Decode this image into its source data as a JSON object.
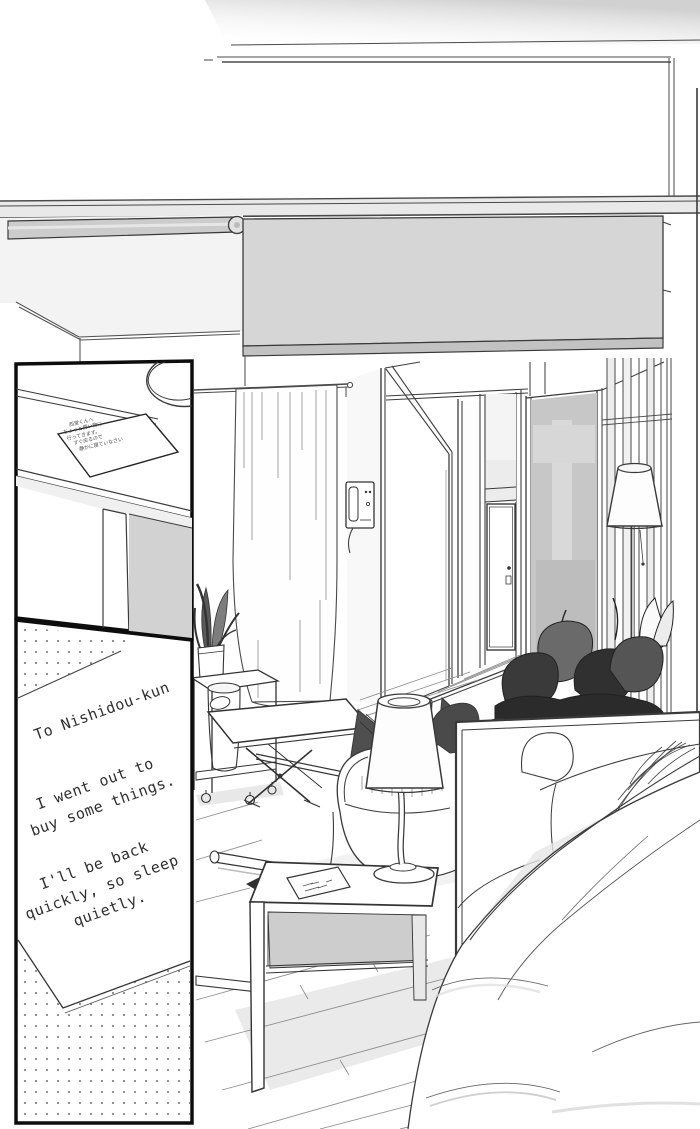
{
  "caption": {
    "block1": {
      "line1": "To Nishidou-kun"
    },
    "block2": {
      "line1": "I went out to",
      "line2": "buy some things."
    },
    "block3": {
      "line1": "I'll be back",
      "line2": "quickly, so sleep",
      "line3": "quietly."
    }
  },
  "inset_panel": {
    "note": {
      "lines": [
        "西堂くんへ",
        "ちょっと買い物に",
        "行ってきます。",
        "すぐ戻るので",
        "静かに寝ていなさい"
      ]
    }
  },
  "colors": {
    "line": "#2e2e2e",
    "blind_gray": "#d6d6d6",
    "blind_bar_gray": "#c2c2c2",
    "partition_gray": "#c7c7c7",
    "plant_dark": "#2b2b2b",
    "cushion_dark": "#4f4f4f",
    "shadow_gray": "#e3e3e3",
    "halftone_dot": "#8a8a8a"
  }
}
